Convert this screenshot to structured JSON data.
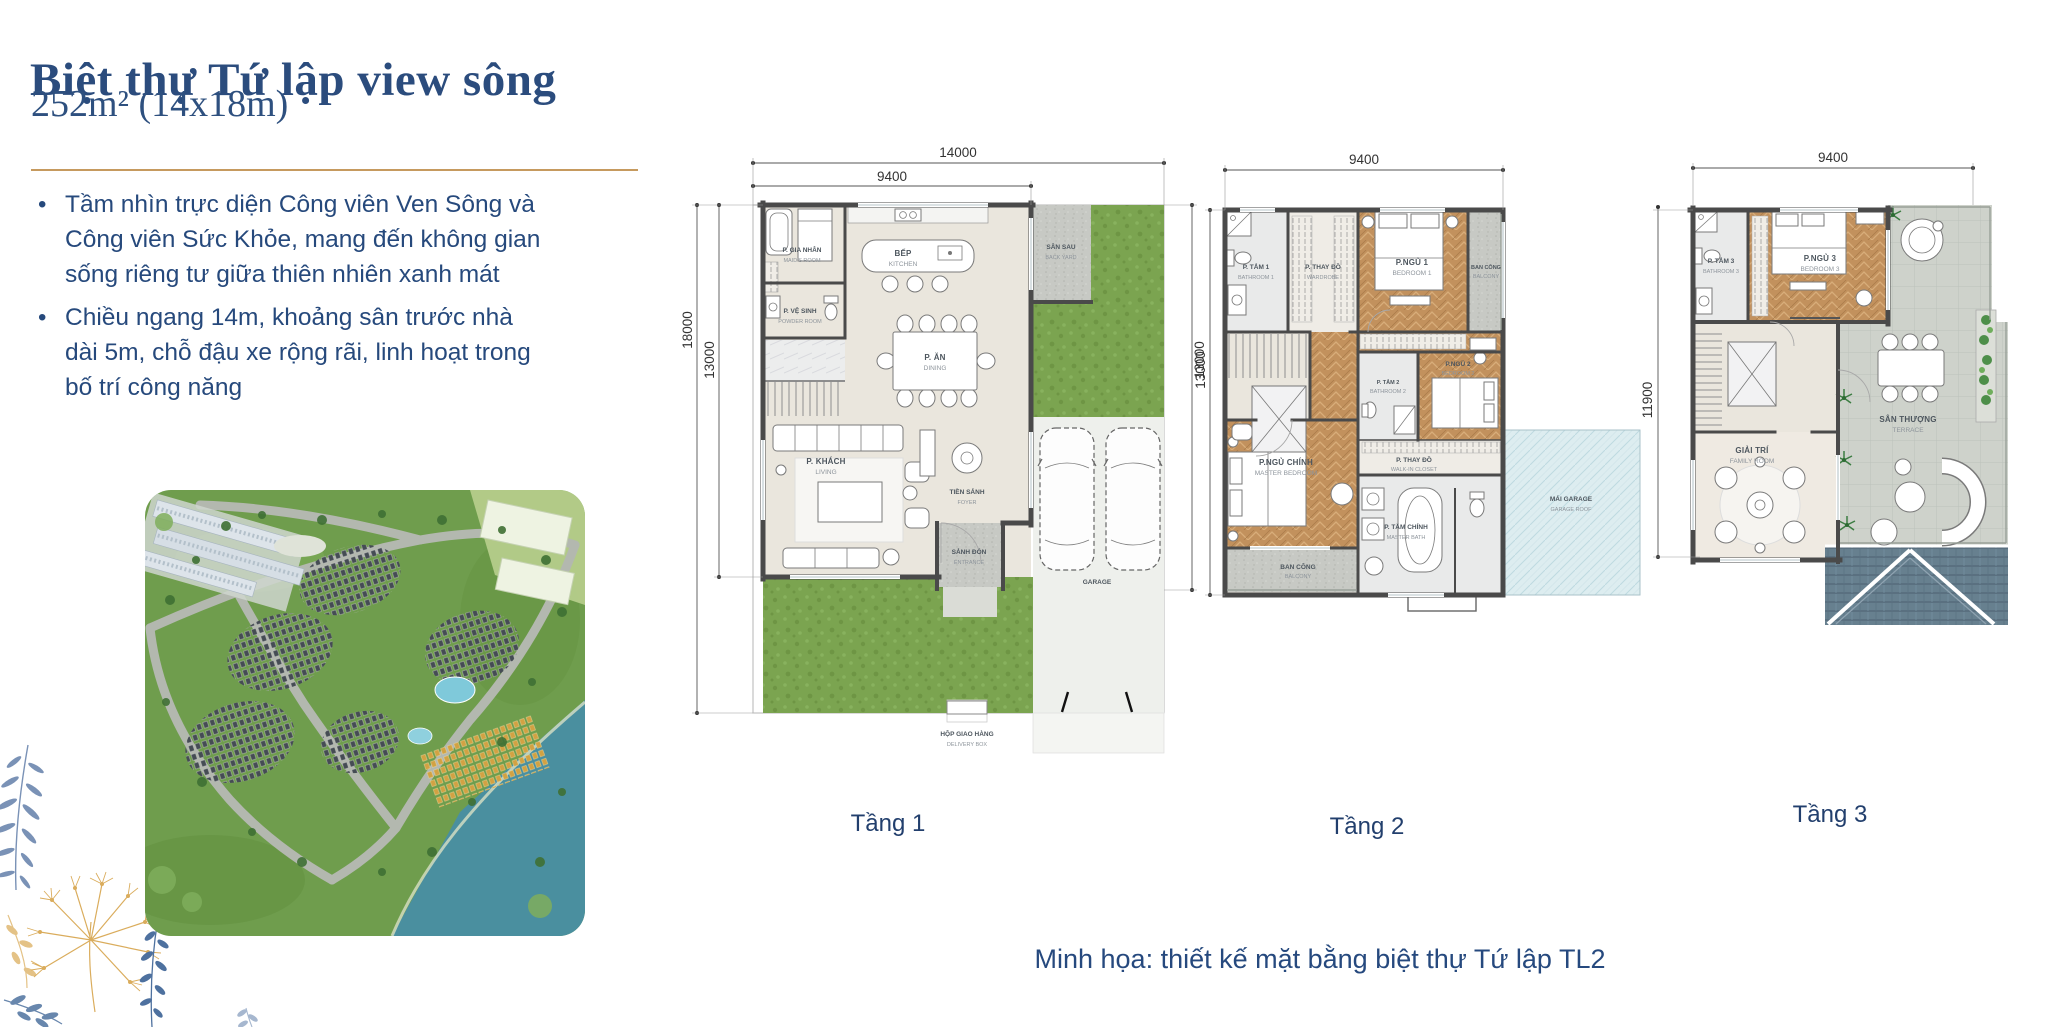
{
  "page": {
    "title": "Biệt thự Tứ lập view sông",
    "subtitle": "252m² (14x18m)",
    "bullets": [
      "Tầm nhìn trực diện Công viên Ven Sông và Công viên Sức Khỏe, mang đến không gian sống riêng tư giữa thiên nhiên xanh mát",
      "Chiều ngang 14m, khoảng sân trước nhà dài 5m, chỗ đậu xe rộng rãi, linh hoạt trong bố trí công năng"
    ],
    "caption": "Minh họa: thiết kế mặt bằng biệt thự Tứ lập TL2"
  },
  "colors": {
    "navy": "#2b4c7d",
    "gold": "#c69a5e"
  },
  "floor1": {
    "label": "Tầng 1",
    "dims": {
      "total_width": "14000",
      "house_width": "9400",
      "total_depth": "18000",
      "house_depth": "13000",
      "side_depth": "13000"
    },
    "rooms": {
      "maid": {
        "vi": "P. GIA NHÂN",
        "en": "MAID'S ROOM"
      },
      "powder": {
        "vi": "P. VỆ SINH",
        "en": "POWDER ROOM"
      },
      "kitchen": {
        "vi": "BẾP",
        "en": "KITCHEN"
      },
      "dining": {
        "vi": "P. ĂN",
        "en": "DINING"
      },
      "living": {
        "vi": "P. KHÁCH",
        "en": "LIVING"
      },
      "foyer": {
        "vi": "TIỀN SẢNH",
        "en": "FOYER"
      },
      "entry": {
        "vi": "SẢNH ĐÓN",
        "en": "ENTRANCE"
      },
      "backyard": {
        "vi": "SÂN SAU",
        "en": "BACK YARD"
      },
      "garage": {
        "vi": "GARAGE"
      },
      "delivery": {
        "vi": "HỘP GIAO HÀNG",
        "en": "DELIVERY BOX"
      }
    }
  },
  "floor2": {
    "label": "Tầng 2",
    "dims": {
      "width": "9400",
      "depth": "13000"
    },
    "rooms": {
      "bath1": {
        "vi": "P. TẮM 1",
        "en": "BATHROOM 1"
      },
      "closet1": {
        "vi": "P. THAY ĐỒ",
        "en": "WARDROBE"
      },
      "bed1": {
        "vi": "P.NGỦ 1",
        "en": "BEDROOM 1"
      },
      "balcony1": {
        "vi": "BAN CÔNG",
        "en": "BALCONY"
      },
      "bath2": {
        "vi": "P. TẮM 2",
        "en": "BATHROOM 2"
      },
      "bed2": {
        "vi": "P.NGỦ 2",
        "en": "BEDROOM 2"
      },
      "master": {
        "vi": "P.NGỦ CHÍNH",
        "en": "MASTER BEDROOM"
      },
      "walkin": {
        "vi": "P. THAY ĐỒ",
        "en": "WALK-IN CLOSET"
      },
      "masterbath": {
        "vi": "P. TẮM CHÍNH",
        "en": "MASTER BATH"
      },
      "balcony2": {
        "vi": "BAN CÔNG",
        "en": "BALCONY"
      },
      "garageroof": {
        "vi": "MÁI GARAGE",
        "en": "GARAGE ROOF"
      }
    }
  },
  "floor3": {
    "label": "Tầng 3",
    "dims": {
      "width": "9400",
      "depth": "11900"
    },
    "rooms": {
      "bath3": {
        "vi": "P. TẮM 3",
        "en": "BATHROOM 3"
      },
      "bed3": {
        "vi": "P.NGỦ 3",
        "en": "BEDROOM 3"
      },
      "family": {
        "vi": "GIẢI TRÍ",
        "en": "FAMILY ROOM"
      },
      "terrace": {
        "vi": "SÂN THƯỢNG",
        "en": "TERRACE"
      }
    }
  }
}
